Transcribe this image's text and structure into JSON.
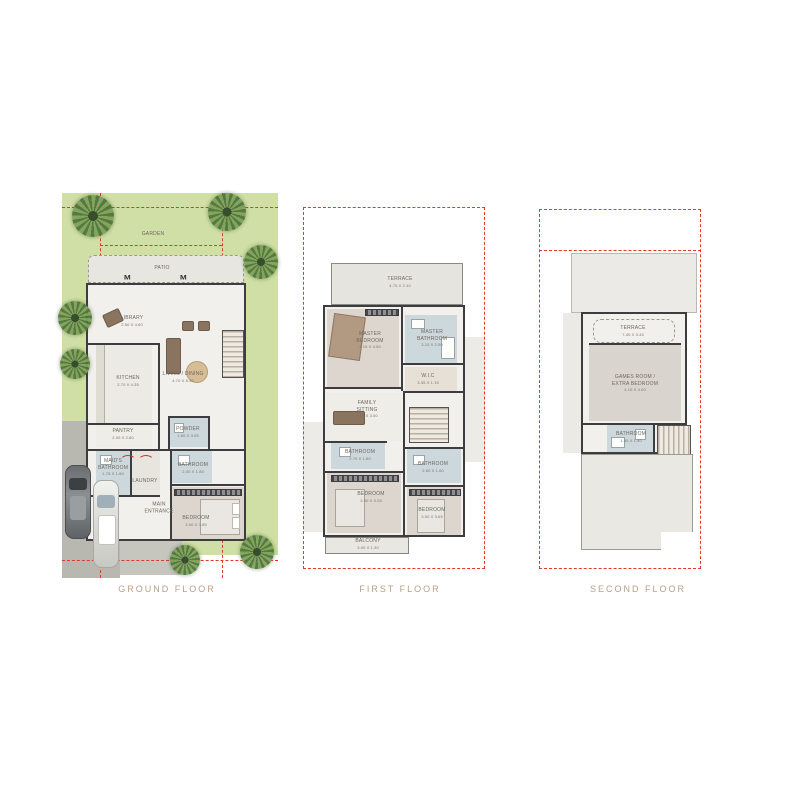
{
  "page_title": "Villa Floor Plans",
  "colors": {
    "boundary_red": "#e2392d",
    "wall_dark": "#3d3d3f",
    "garden_green": "#cfdfa5",
    "tile_grey": "#e6e4df",
    "bathroom_blue": "#ccd8dc",
    "carpet_grey": "#dcd6cf",
    "title_tan": "#b7a089"
  },
  "floors": [
    {
      "id": "ground",
      "title": "GROUND FLOOR",
      "rooms": [
        {
          "label": "GARDEN",
          "dims": ""
        },
        {
          "label": "PATIO",
          "dims": ""
        },
        {
          "label": "LIBRARY",
          "dims": "2.50 X 4.60"
        },
        {
          "label": "LIVING / DINING",
          "dims": "4.70 X 8.30"
        },
        {
          "label": "KITCHEN",
          "dims": "2.70 X 4.35"
        },
        {
          "label": "PANTRY",
          "dims": "2.00 X 2.80"
        },
        {
          "label": "POWDER",
          "dims": "1.60 X 3.05"
        },
        {
          "label": "MAID'S BATHROOM",
          "dims": "1.75 X 1.60"
        },
        {
          "label": "LAUNDRY",
          "dims": ""
        },
        {
          "label": "BATHROOM",
          "dims": "2.00 X 1.85"
        },
        {
          "label": "BEDROOM",
          "dims": "3.00 X 3.85"
        },
        {
          "label": "MAIN ENTRANCE",
          "dims": ""
        }
      ]
    },
    {
      "id": "first",
      "title": "FIRST FLOOR",
      "rooms": [
        {
          "label": "TERRACE",
          "dims": "4.70 X 2.10"
        },
        {
          "label": "MASTER BEDROOM",
          "dims": "4.15 X 4.50"
        },
        {
          "label": "MASTER BATHROOM",
          "dims": "3.10 X 2.50"
        },
        {
          "label": "W.I.C",
          "dims": "3.35 X 1.15"
        },
        {
          "label": "FAMILY SITTING",
          "dims": "4.00 X 3.50"
        },
        {
          "label": "BATHROOM",
          "dims": "2.70 X 1.60"
        },
        {
          "label": "BATHROOM",
          "dims": "2.60 X 1.60"
        },
        {
          "label": "BEDROOM",
          "dims": "3.90 X 3.25"
        },
        {
          "label": "BEDROOM",
          "dims": "3.50 X 3.65"
        },
        {
          "label": "BALCONY",
          "dims": "3.90 X 1.30"
        }
      ]
    },
    {
      "id": "second",
      "title": "SECOND FLOOR",
      "rooms": [
        {
          "label": "TERRACE",
          "dims": "7.40 X 3.45"
        },
        {
          "label": "GAMES ROOM / EXTRA BEDROOM",
          "dims": "4.10 X 4.00"
        },
        {
          "label": "BATHROOM",
          "dims": "1.85 X 1.40"
        }
      ]
    }
  ]
}
